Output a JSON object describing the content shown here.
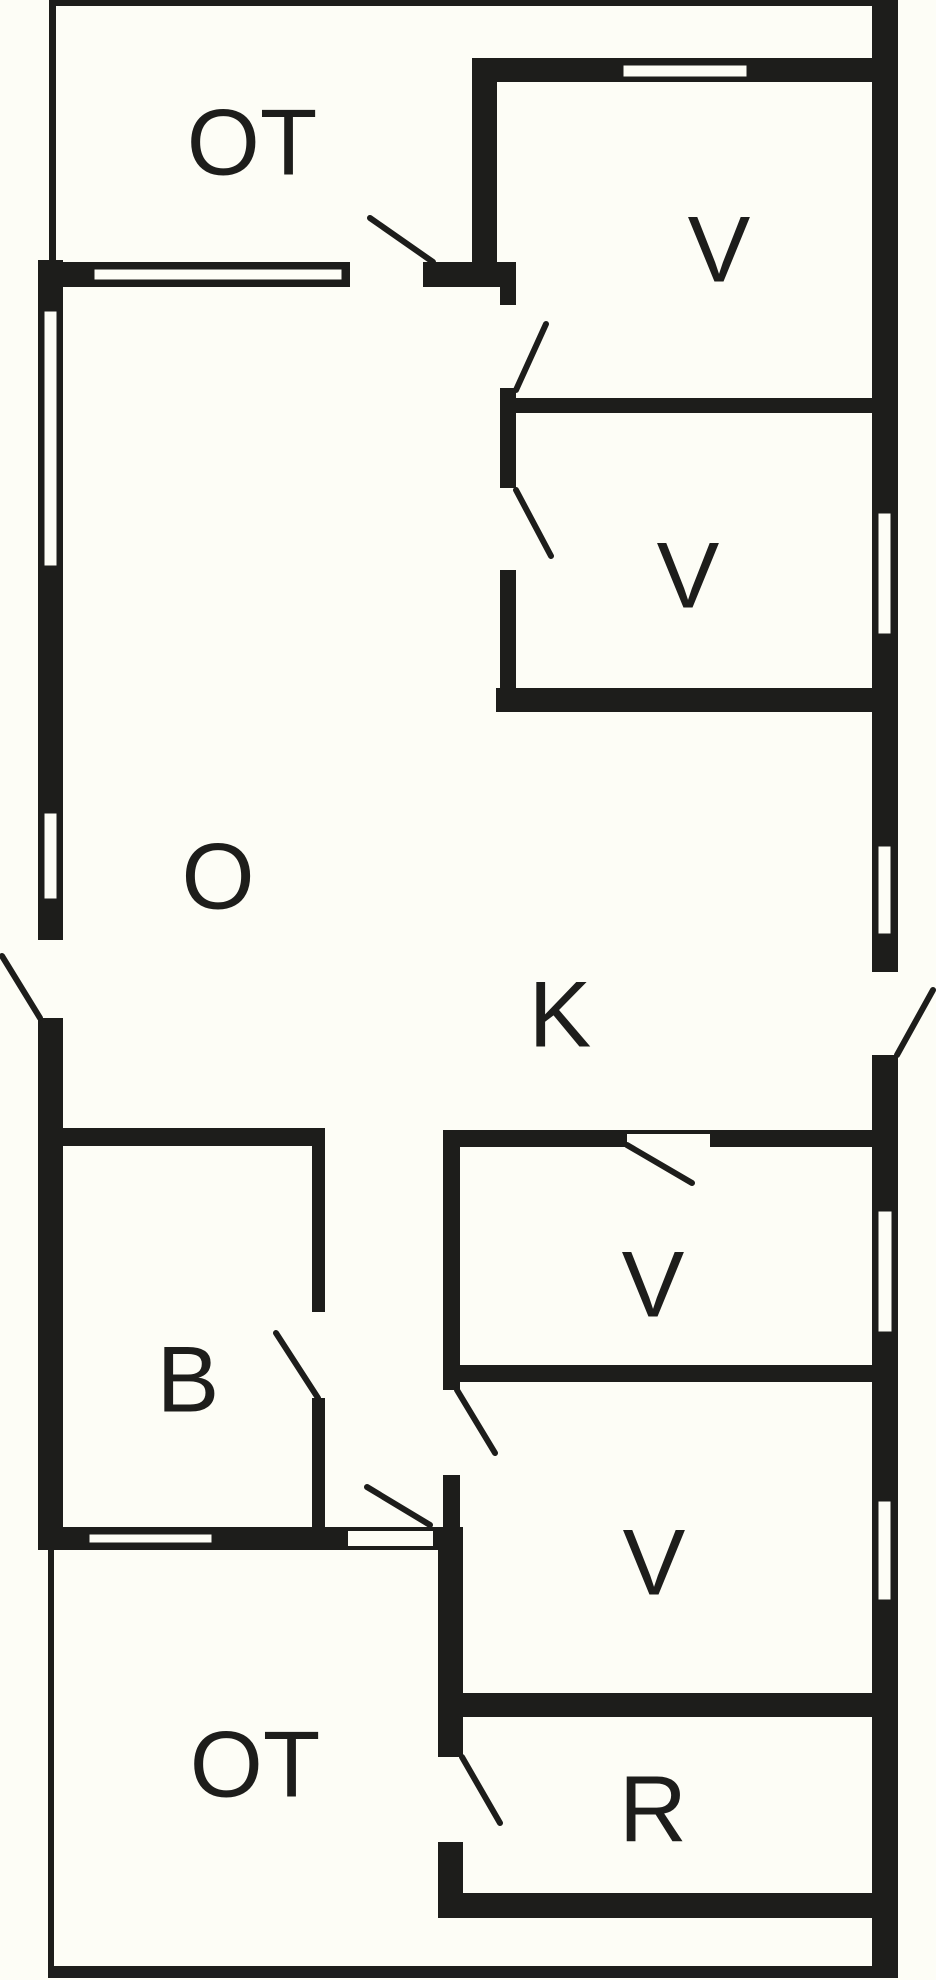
{
  "plan": {
    "title": "floor-plan",
    "canvas": {
      "width": 936,
      "height": 1980,
      "bg": "#fdfdf6",
      "wall_color": "#1d1d1b",
      "window_fill": "#fdfdf6",
      "swing_color": "#1d1d1b",
      "label_color": "#1d1d1b",
      "label_font_size": 94
    },
    "rooms": [
      {
        "id": "ot-top",
        "label": "OT",
        "cx": 252,
        "cy": 142
      },
      {
        "id": "v1",
        "label": "V",
        "cx": 719,
        "cy": 249
      },
      {
        "id": "v2",
        "label": "V",
        "cx": 688,
        "cy": 575
      },
      {
        "id": "o",
        "label": "O",
        "cx": 218,
        "cy": 876
      },
      {
        "id": "k",
        "label": "K",
        "cx": 560,
        "cy": 1014
      },
      {
        "id": "b",
        "label": "B",
        "cx": 188,
        "cy": 1379
      },
      {
        "id": "v3",
        "label": "V",
        "cx": 653,
        "cy": 1284
      },
      {
        "id": "v4",
        "label": "V",
        "cx": 654,
        "cy": 1562
      },
      {
        "id": "r",
        "label": "R",
        "cx": 653,
        "cy": 1809
      },
      {
        "id": "ot-bottom",
        "label": "OT",
        "cx": 255,
        "cy": 1764
      }
    ],
    "walls": [
      {
        "id": "ot-top-edge",
        "x": 49,
        "y": 0,
        "w": 849,
        "h": 6
      },
      {
        "id": "ot-top-left-edge",
        "x": 49,
        "y": 0,
        "w": 7,
        "h": 260
      },
      {
        "id": "ot-bottom-left-edge",
        "x": 48,
        "y": 1550,
        "w": 6,
        "h": 425
      },
      {
        "id": "ot-bottom-edge",
        "x": 48,
        "y": 1966,
        "w": 850,
        "h": 12
      },
      {
        "id": "right-exterior-wall",
        "x": 872,
        "y": 3,
        "w": 26,
        "h": 1965
      },
      {
        "id": "left-exterior-wall",
        "x": 38,
        "y": 260,
        "w": 25,
        "h": 1290
      },
      {
        "id": "v1-top-wall",
        "x": 472,
        "y": 58,
        "w": 400,
        "h": 24
      },
      {
        "id": "below-ot-wall",
        "x": 38,
        "y": 262,
        "w": 312,
        "h": 25
      },
      {
        "id": "below-ot-corner-block",
        "x": 423,
        "y": 262,
        "w": 93,
        "h": 25
      },
      {
        "id": "bottom-left-wall",
        "x": 38,
        "y": 1527,
        "w": 310,
        "h": 23
      },
      {
        "id": "corridor-bottom-block",
        "x": 433,
        "y": 1527,
        "w": 30,
        "h": 23
      },
      {
        "id": "ot-v1-divider",
        "x": 472,
        "y": 58,
        "w": 25,
        "h": 204
      },
      {
        "id": "vestibule-wall-a",
        "x": 500,
        "y": 262,
        "w": 16,
        "h": 43
      },
      {
        "id": "vestibule-wall-b",
        "x": 500,
        "y": 388,
        "w": 16,
        "h": 100
      },
      {
        "id": "vestibule-wall-c",
        "x": 500,
        "y": 570,
        "w": 16,
        "h": 142
      },
      {
        "id": "v1-v2-wall",
        "x": 500,
        "y": 398,
        "w": 372,
        "h": 15
      },
      {
        "id": "v2-bottom-wall",
        "x": 496,
        "y": 688,
        "w": 376,
        "h": 24
      },
      {
        "id": "v3-top-wall",
        "x": 443,
        "y": 1130,
        "w": 429,
        "h": 17
      },
      {
        "id": "v3-left-wall-a",
        "x": 443,
        "y": 1147,
        "w": 17,
        "h": 243
      },
      {
        "id": "v3-left-wall-b",
        "x": 443,
        "y": 1475,
        "w": 17,
        "h": 52
      },
      {
        "id": "v3-v4-wall",
        "x": 458,
        "y": 1365,
        "w": 414,
        "h": 17
      },
      {
        "id": "v4-r-wall",
        "x": 463,
        "y": 1693,
        "w": 409,
        "h": 24
      },
      {
        "id": "r-left-wall-a",
        "x": 438,
        "y": 1550,
        "w": 25,
        "h": 207
      },
      {
        "id": "r-left-wall-b",
        "x": 438,
        "y": 1842,
        "w": 25,
        "h": 76
      },
      {
        "id": "r-bottom-wall",
        "x": 438,
        "y": 1893,
        "w": 434,
        "h": 25
      },
      {
        "id": "b-top-wall",
        "x": 63,
        "y": 1128,
        "w": 262,
        "h": 18
      },
      {
        "id": "b-right-wall-a",
        "x": 312,
        "y": 1146,
        "w": 13,
        "h": 166
      },
      {
        "id": "b-right-wall-b",
        "x": 312,
        "y": 1398,
        "w": 13,
        "h": 129
      }
    ],
    "door_openings": [
      {
        "id": "k-exterior-door-gap",
        "x": 872,
        "y": 972,
        "w": 26,
        "h": 83
      },
      {
        "id": "o-exterior-door-gap",
        "x": 38,
        "y": 940,
        "w": 25,
        "h": 78
      },
      {
        "id": "ot-top-door-gap",
        "x": 350,
        "y": 262,
        "w": 73,
        "h": 25
      },
      {
        "id": "ot-bottom-door-gap",
        "x": 348,
        "y": 1527,
        "w": 85,
        "h": 23
      },
      {
        "id": "v3-door-gap",
        "x": 627,
        "y": 1130,
        "w": 83,
        "h": 17
      }
    ],
    "thresholds": [
      {
        "id": "ot-bottom-door-sill-top",
        "x": 348,
        "y": 1527,
        "w": 85,
        "h": 4
      },
      {
        "id": "ot-bottom-door-sill-bottom",
        "x": 348,
        "y": 1546,
        "w": 85,
        "h": 4
      },
      {
        "id": "v3-door-sill",
        "x": 627,
        "y": 1130,
        "w": 83,
        "h": 4
      }
    ],
    "windows": [
      {
        "id": "window-left-1",
        "x": 43,
        "y": 310,
        "w": 15,
        "h": 257
      },
      {
        "id": "window-left-2",
        "x": 43,
        "y": 812,
        "w": 15,
        "h": 88
      },
      {
        "id": "window-right-v2",
        "x": 877,
        "y": 512,
        "w": 15,
        "h": 123
      },
      {
        "id": "window-right-k",
        "x": 877,
        "y": 845,
        "w": 15,
        "h": 90
      },
      {
        "id": "window-right-v3",
        "x": 877,
        "y": 1210,
        "w": 16,
        "h": 123
      },
      {
        "id": "window-right-v4",
        "x": 877,
        "y": 1500,
        "w": 15,
        "h": 101
      },
      {
        "id": "window-v1-top",
        "x": 622,
        "y": 64,
        "w": 126,
        "h": 14
      },
      {
        "id": "window-below-ot",
        "x": 93,
        "y": 268,
        "w": 250,
        "h": 13
      },
      {
        "id": "window-below-b",
        "x": 88,
        "y": 1533,
        "w": 125,
        "h": 11
      }
    ],
    "door_swings": [
      {
        "id": "swing-ot-top-door",
        "x1": 433,
        "y1": 262,
        "x2": 370,
        "y2": 218
      },
      {
        "id": "swing-v1-door",
        "x1": 516,
        "y1": 390,
        "x2": 546,
        "y2": 324
      },
      {
        "id": "swing-v2-door",
        "x1": 516,
        "y1": 490,
        "x2": 551,
        "y2": 556
      },
      {
        "id": "swing-o-exterior",
        "x1": 40,
        "y1": 1018,
        "x2": 2,
        "y2": 956
      },
      {
        "id": "swing-k-exterior",
        "x1": 897,
        "y1": 1055,
        "x2": 933,
        "y2": 990
      },
      {
        "id": "swing-v3-door",
        "x1": 627,
        "y1": 1145,
        "x2": 692,
        "y2": 1183
      },
      {
        "id": "swing-v4-door",
        "x1": 457,
        "y1": 1390,
        "x2": 495,
        "y2": 1453
      },
      {
        "id": "swing-r-door",
        "x1": 462,
        "y1": 1757,
        "x2": 500,
        "y2": 1823
      },
      {
        "id": "swing-b-door",
        "x1": 318,
        "y1": 1398,
        "x2": 276,
        "y2": 1333
      },
      {
        "id": "swing-ot-bottom-door",
        "x1": 430,
        "y1": 1525,
        "x2": 367,
        "y2": 1487
      }
    ]
  }
}
